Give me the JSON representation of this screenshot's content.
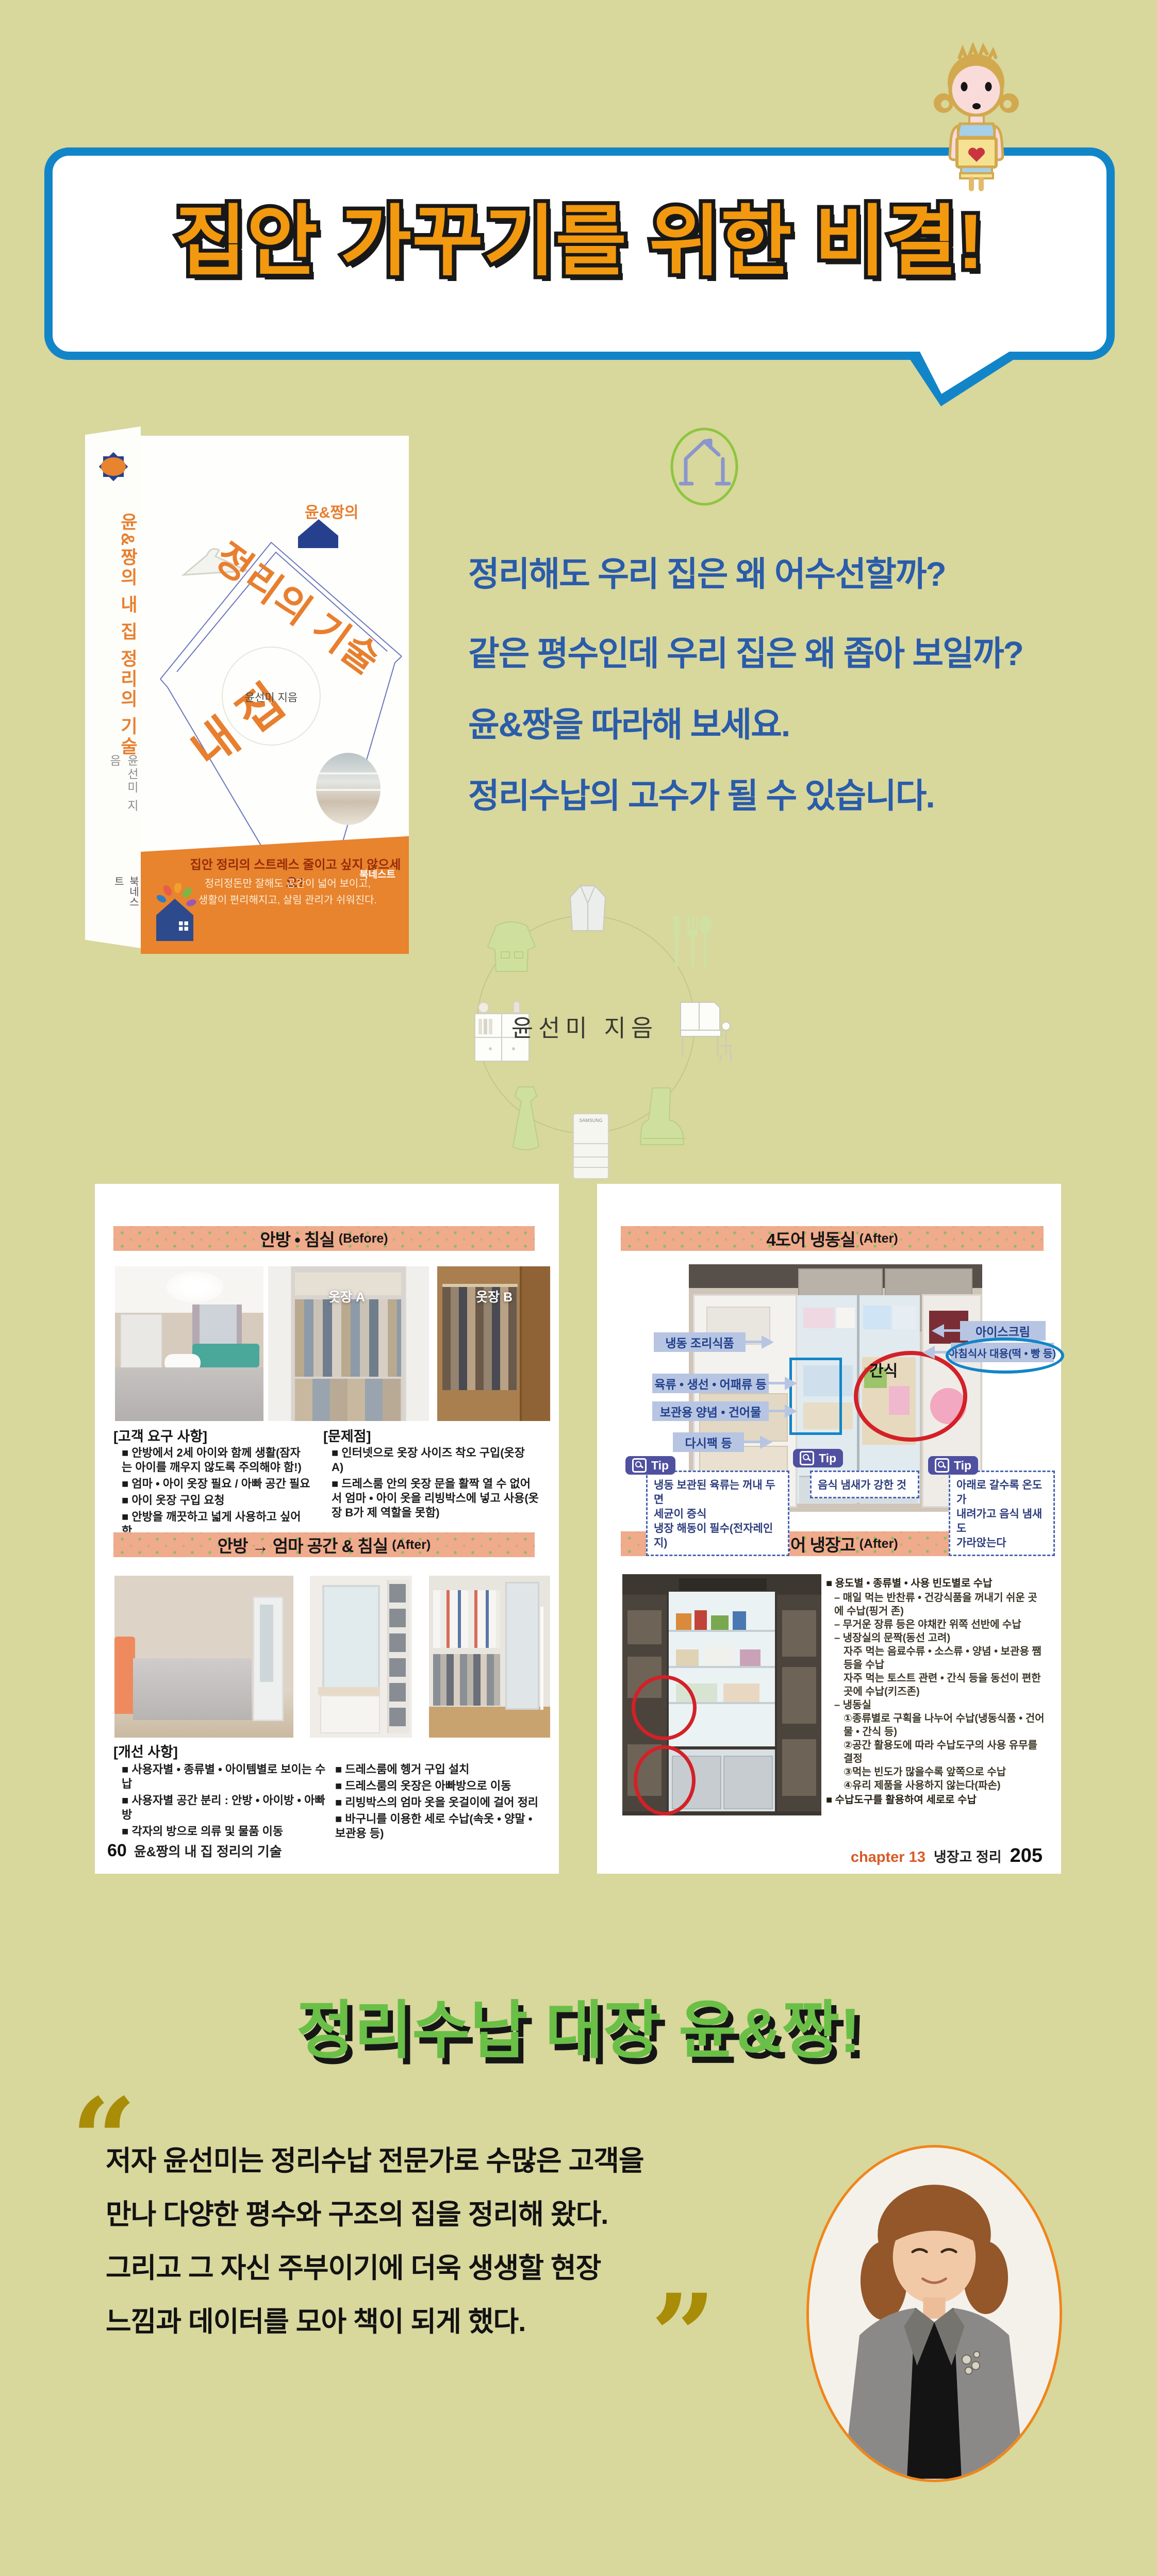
{
  "colors": {
    "background": "#d8d79c",
    "bubble_border": "#1285c8",
    "slogan_orange": "#f2990f",
    "intro_blue": "#2a5caa",
    "header_band": "#f0aa8c",
    "header_dot_green": "#76c15e",
    "title_green": "#6abf47",
    "quote_gold": "#a98c07",
    "cover_orange": "#e8832e",
    "callout_bg": "#b7c5e2",
    "callout_text": "#21408c",
    "tip_badge": "#5050a0",
    "red_circle": "#d42027"
  },
  "speech_bubble": {
    "text": "집안 가꾸기를 위한 비결!"
  },
  "book": {
    "spine": {
      "title": "윤&짱의 내 집 정리의 기술",
      "author": "윤선미 지음",
      "publisher": "북네스트"
    },
    "cover": {
      "series": "윤&짱의",
      "title_line1": "내 집",
      "title_line2": "정리의 기술",
      "author": "윤선미 지음",
      "band": {
        "headline": "집안 정리의 스트레스 줄이고 싶지 않으세요?",
        "line2": "정리정돈만 잘해도 공간이 넓어 보이고,",
        "line3": "생활이 편리해지고, 살림 관리가 쉬워진다.",
        "publisher": "북네스트"
      }
    }
  },
  "intro": {
    "lines": [
      "정리해도 우리 집은 왜 어수선할까?",
      "같은 평수인데 우리 집은 왜 좁아 보일까?",
      "윤&짱을 따라해 보세요.",
      "정리수납의 고수가 될 수 있습니다."
    ],
    "author_credit": "윤선미 지음",
    "decor_fridge_label": "SAMSUNG"
  },
  "left_page": {
    "before": {
      "title": "안방 • 침실",
      "suffix": "(Before)",
      "photo_label_a": "옷장 A",
      "photo_label_b": "옷장 B",
      "requirements_title": "[고객 요구 사항]",
      "requirements": [
        "■ 안방에서 2세 아이와 함께 생활(잠자는 아이를 깨우지 않도록 주의해야 함!)",
        "■ 엄마 • 아이 옷장 필요 / 아빠 공간 필요",
        "■ 아이 옷장 구입 요청",
        "■ 안방을 깨끗하고 넓게 사용하고 싶어함"
      ],
      "problems_title": "[문제점]",
      "problems": [
        "■ 인터넷으로 옷장 사이즈 착오 구입(옷장 A)",
        "■ 드레스룸 안의 옷장 문을 활짝 열 수 없어서 엄마 • 아이 옷을 리빙박스에 넣고 사용(옷장 B가 제 역할을 못함)"
      ]
    },
    "after": {
      "title": "안방 → 엄마 공간 & 침실",
      "suffix": "(After)",
      "improvements_title": "[개선 사항]",
      "improvements_col1": [
        "■ 사용자별 • 종류별 • 아이템별로 보이는 수납",
        "■ 사용자별 공간 분리 : 안방 • 아이방 • 아빠방",
        "■ 각자의 방으로 의류 및 물품 이동"
      ],
      "improvements_col2": [
        "■ 드레스룸에 헹거 구입 설치",
        "■ 드레스룸의 옷장은 아빠방으로 이동",
        "■ 리빙박스의 엄마 옷을 옷걸이에 걸어 정리",
        "■ 바구니를 이용한 세로 수납(속옷 • 양말 • 보관용 등)"
      ]
    },
    "footer": {
      "page_no": "60",
      "text": "윤&짱의 내 집 정리의 기술"
    }
  },
  "right_page": {
    "freezer": {
      "title": "4도어 냉동실",
      "suffix": "(After)",
      "labels_left": [
        "냉동 조리식품",
        "육류 • 생선 • 어패류 등",
        "보관용 양념 • 건어물",
        "다시팩 등"
      ],
      "labels_right": [
        "아이스크림",
        "아침식사 대용(떡 • 빵 등)"
      ],
      "annotation": "간식",
      "tip_label": "Tip",
      "tips": [
        "냉동 보관된 육류는 꺼내 두면\n세균이 증식\n냉장 해동이 필수(전자레인지)",
        "음식 냄새가 강한 것",
        "아래로 갈수록 온도가\n내려가고 음식 냄새도\n가라앉는다"
      ]
    },
    "fridge": {
      "title": "4도어 냉장고",
      "suffix": "(After)",
      "bullets": [
        {
          "indent": 0,
          "text": "■ 용도별 • 종류별 • 사용 빈도별로 수납"
        },
        {
          "indent": 1,
          "text": "– 매일 먹는 반찬류 • 건강식품을 꺼내기 쉬운 곳에 수납(핑거 존)"
        },
        {
          "indent": 1,
          "text": "– 무거운 장류 등은 야채칸 위쪽 선반에 수납"
        },
        {
          "indent": 1,
          "text": "– 냉장실의 문짝(동선 고려)"
        },
        {
          "indent": 2,
          "text": "자주 먹는 음료수류 • 소스류 • 양념 • 보관용 쨈 등을 수납"
        },
        {
          "indent": 2,
          "text": "자주 먹는 토스트 관련 • 간식 등을 동선이 편한 곳에 수납(키즈존)"
        },
        {
          "indent": 1,
          "text": "– 냉동실"
        },
        {
          "indent": 2,
          "text": "①종류별로 구획을 나누어 수납(냉동식품 • 건어물 • 간식 등)"
        },
        {
          "indent": 2,
          "text": "②공간 활용도에 따라 수납도구의 사용 유무를 결정"
        },
        {
          "indent": 2,
          "text": "③먹는 빈도가 많을수록 앞쪽으로 수납"
        },
        {
          "indent": 2,
          "text": "④유리 제품을 사용하지 않는다(파손)"
        },
        {
          "indent": 0,
          "text": "■ 수납도구를 활용하여 세로로 수납"
        }
      ]
    },
    "footer": {
      "chapter": "chapter 13",
      "text": "냉장고 정리",
      "page_no": "205"
    }
  },
  "outro": {
    "title": "정리수납 대장 윤&짱!",
    "quote": [
      "저자 윤선미는 정리수납 전문가로 수많은 고객을",
      "만나 다양한 평수와 구조의 집을 정리해 왔다.",
      "그리고 그 자신 주부이기에 더욱 생생할 현장",
      "느낌과 데이터를 모아 책이 되게 했다."
    ]
  }
}
